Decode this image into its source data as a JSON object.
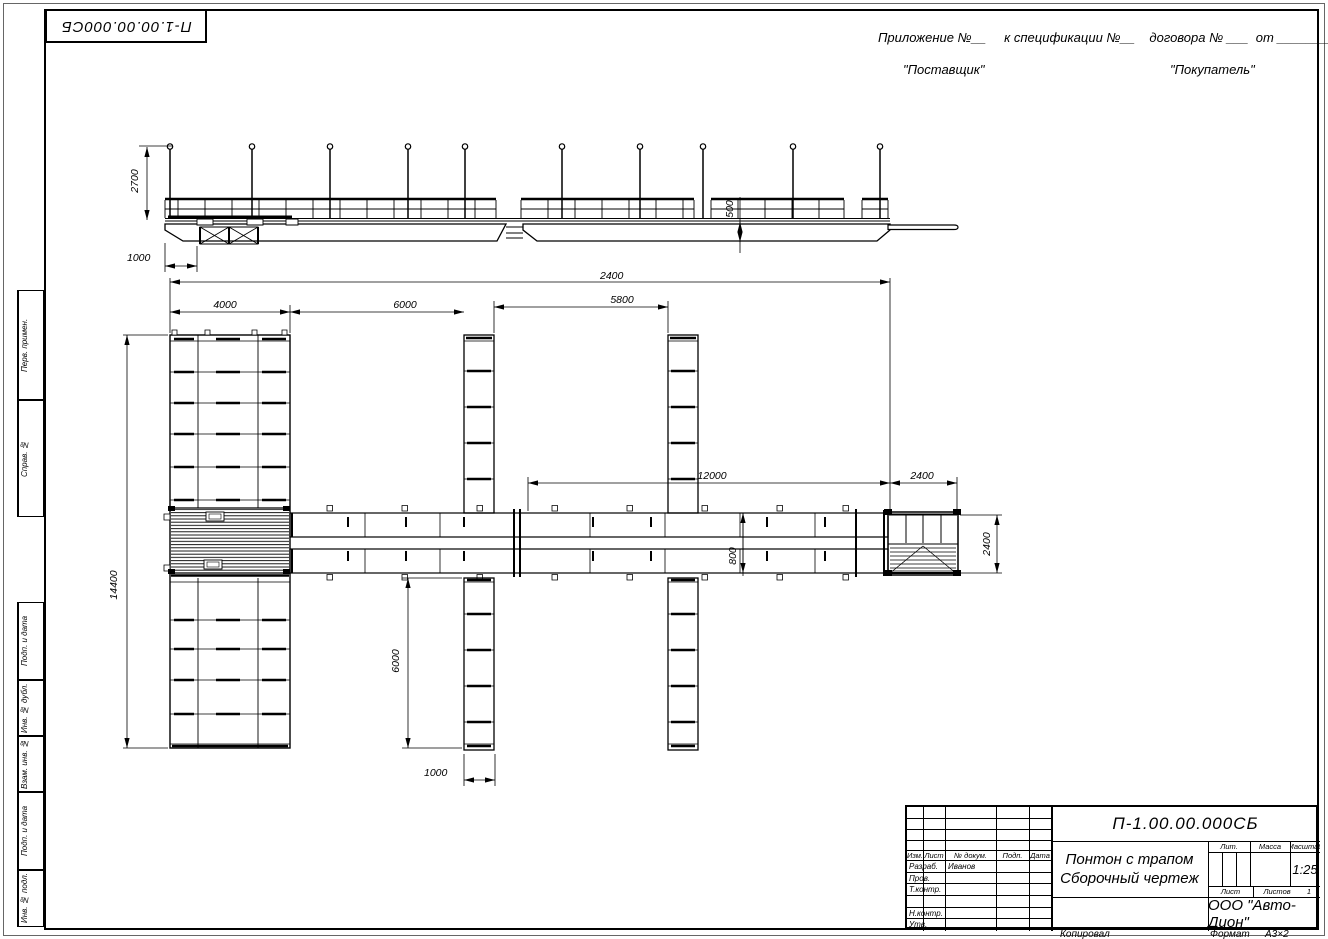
{
  "sheet": {
    "doc_number_top": "П-1.00.00.000СБ",
    "appendix_line": "Приложение №__     к спецификации №__    договора № ___  от __________",
    "supplier": "\"Поставщик\"",
    "buyer": "\"Покупатель\"",
    "copied_label": "Копировал",
    "format_label": "Формат",
    "format_value": "А3×2"
  },
  "margins": {
    "perv_primen": "Перв. примен.",
    "sprav_no": "Справ. №",
    "podp_data_1": "Подп. и дата",
    "inv_dubl": "Инв. № дубл.",
    "vzam_inv": "Взам. инв. №",
    "podp_data_2": "Подп. и дата",
    "inv_podl": "Инв. № подл."
  },
  "title_block": {
    "doc_number": "П-1.00.00.000СБ",
    "title_line1": "Понтон с трапом",
    "title_line2": "Сборочный чертеж",
    "col_izm": "Изм.",
    "col_list": "Лист",
    "col_ndokum": "№ докум.",
    "col_podp": "Подп.",
    "col_data": "Дата",
    "razrab_label": "Разраб.",
    "razrab_value": "Иванов",
    "prov_label": "Пров.",
    "tkontr_label": "Т.контр.",
    "nkontr_label": "Н.контр.",
    "utv_label": "Утв.",
    "lit_label": "Лит.",
    "massa_label": "Масса",
    "masshtab_label": "Масштаб",
    "scale_value": "1:25",
    "list_label": "Лист",
    "listov_label": "Листов",
    "listov_value": "1",
    "company": "ООО \"Авто-Дион\""
  },
  "dims": {
    "d2700": "2700",
    "d1000_side": "1000",
    "d500": "500",
    "d2400_overall": "2400",
    "d4000": "4000",
    "d6000_gap": "6000",
    "d5800": "5800",
    "d12000": "12000",
    "d2400_platform": "2400",
    "d800": "800",
    "d14400": "14400",
    "d6000_finger": "6000",
    "d1000_finger": "1000",
    "d2400_platform_w": "2400"
  }
}
